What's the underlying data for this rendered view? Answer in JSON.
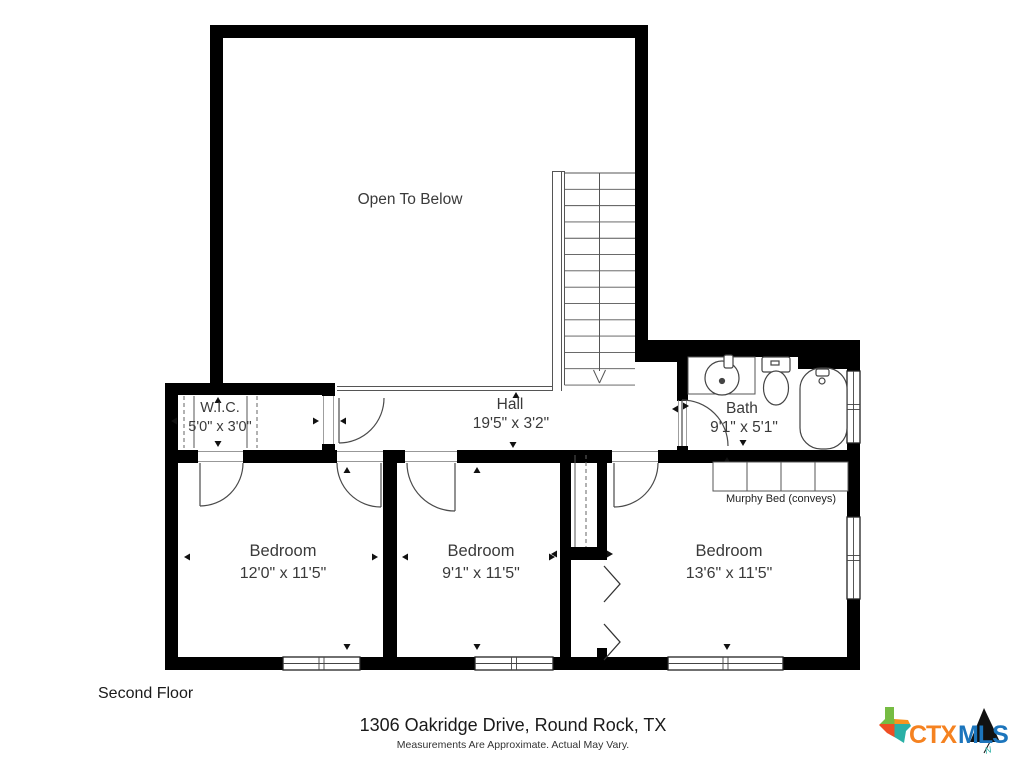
{
  "floor_plan": {
    "floor_label": "Second Floor",
    "open_area_label": "Open To Below",
    "rooms": {
      "wic": {
        "name": "W.I.C.",
        "dims": "5'0\" x 3'0\""
      },
      "hall": {
        "name": "Hall",
        "dims": "19'5\" x 3'2\""
      },
      "bath": {
        "name": "Bath",
        "dims": "9'1\" x 5'1\""
      },
      "bedroom_left": {
        "name": "Bedroom",
        "dims": "12'0\" x 11'5\""
      },
      "bedroom_middle": {
        "name": "Bedroom",
        "dims": "9'1\" x 11'5\""
      },
      "bedroom_right": {
        "name": "Bedroom",
        "dims": "13'6\" x 11'5\""
      }
    },
    "annotations": {
      "murphy_bed": "Murphy Bed (conveys)"
    }
  },
  "footer": {
    "address": "1306 Oakridge Drive, Round Rock, TX",
    "disclaimer": "Measurements Are Approximate. Actual May Vary."
  },
  "logo": {
    "ctx": "CTX",
    "mls": "MLS",
    "compass_n": "N",
    "colors": {
      "ctx_orange": "#F58220",
      "mls_blue": "#1C75BC",
      "texas_green": "#76BC43",
      "texas_orange": "#F7941E",
      "texas_red": "#EE4E23",
      "texas_teal": "#2AB0A6",
      "mountain_black": "#111111"
    }
  }
}
